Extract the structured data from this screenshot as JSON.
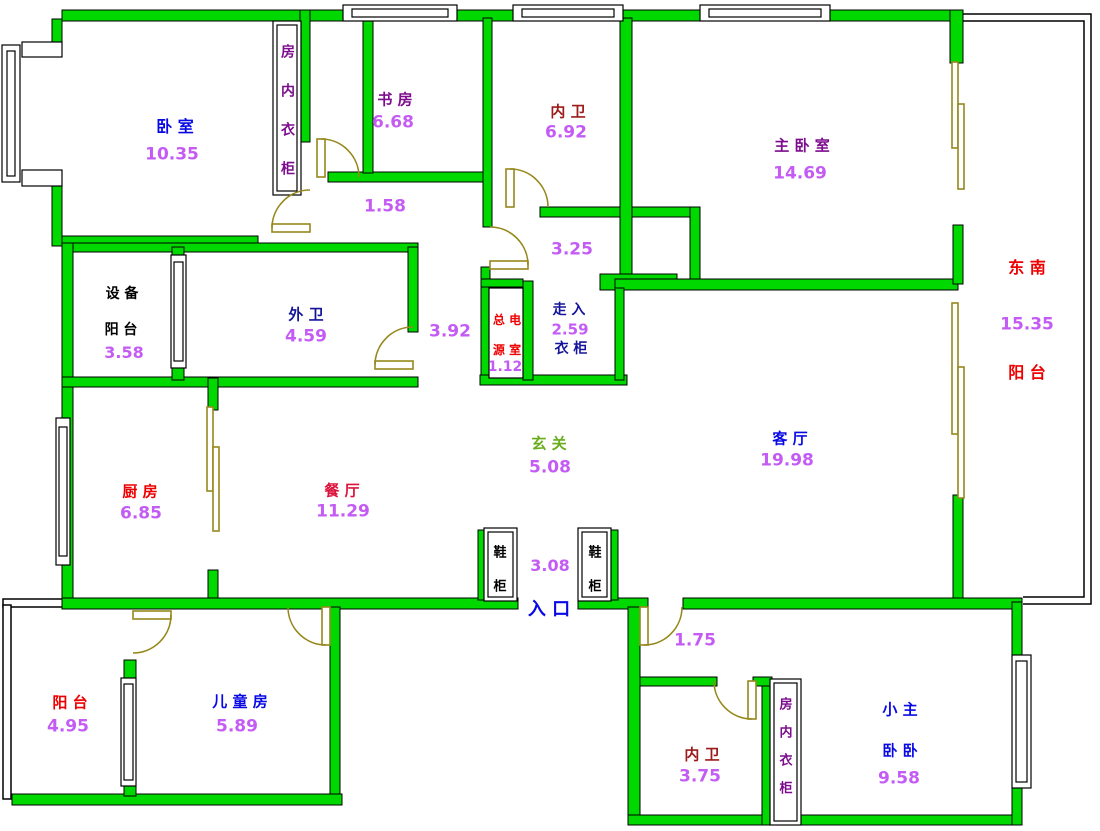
{
  "plan": {
    "title": "apartment-floor-plan",
    "palette": {
      "wall_green": "#00D900",
      "wall_outline": "#000000",
      "door_olive": "#96881C",
      "room_blue": "#0909E6",
      "room_purple": "#7D0C8E",
      "room_darkred": "#9B1A1A",
      "room_red": "#EE0000",
      "room_crimson": "#DC143C",
      "room_navy": "#14149B",
      "hall_green": "#69AD1C",
      "area_number": "#C45BF5",
      "plain_black": "#000000"
    },
    "labels": [
      {
        "name": "bedroom-label",
        "text": "卧 室",
        "x": 175,
        "y": 127,
        "color": "room_blue",
        "size": 16
      },
      {
        "name": "bedroom-area",
        "text": "10.35",
        "x": 172,
        "y": 155,
        "color": "area_number",
        "size": 17
      },
      {
        "name": "bedroom-closet-label",
        "text": "房内衣柜",
        "x": 288,
        "y": 111,
        "color": "room_purple",
        "size": 14,
        "vertical": true,
        "gap": 25
      },
      {
        "name": "study-label",
        "text": "书 房",
        "x": 395,
        "y": 100,
        "color": "room_purple",
        "size": 15
      },
      {
        "name": "study-area",
        "text": "6.68",
        "x": 393,
        "y": 123,
        "color": "area_number",
        "size": 17
      },
      {
        "name": "inner-bath-top-label",
        "text": "内 卫",
        "x": 568,
        "y": 112,
        "color": "room_darkred",
        "size": 15
      },
      {
        "name": "inner-bath-top-area",
        "text": "6.92",
        "x": 566,
        "y": 133,
        "color": "area_number",
        "size": 17
      },
      {
        "name": "master-bedroom-label",
        "text": "主 卧 室",
        "x": 802,
        "y": 146,
        "color": "room_purple",
        "size": 15
      },
      {
        "name": "master-bedroom-area",
        "text": "14.69",
        "x": 800,
        "y": 174,
        "color": "area_number",
        "size": 17
      },
      {
        "name": "corridor-1-area",
        "text": "1.58",
        "x": 385,
        "y": 207,
        "color": "area_number",
        "size": 17
      },
      {
        "name": "corridor-2-area",
        "text": "3.25",
        "x": 572,
        "y": 250,
        "color": "area_number",
        "size": 17
      },
      {
        "name": "southeast-label",
        "text": "东 南",
        "x": 1027,
        "y": 268,
        "color": "room_red",
        "size": 16
      },
      {
        "name": "se-balcony-area",
        "text": "15.35",
        "x": 1027,
        "y": 325,
        "color": "area_number",
        "size": 17
      },
      {
        "name": "se-balcony-label",
        "text": "阳 台",
        "x": 1027,
        "y": 373,
        "color": "room_red",
        "size": 16
      },
      {
        "name": "equip-balcony-label-1",
        "text": "设 备",
        "x": 122,
        "y": 294,
        "color": "plain_black",
        "size": 14
      },
      {
        "name": "equip-balcony-label-2",
        "text": "阳 台",
        "x": 121,
        "y": 330,
        "color": "plain_black",
        "size": 14
      },
      {
        "name": "equip-balcony-area",
        "text": "3.58",
        "x": 124,
        "y": 353,
        "color": "area_number",
        "size": 16
      },
      {
        "name": "outer-bath-label",
        "text": "外 卫",
        "x": 306,
        "y": 315,
        "color": "room_navy",
        "size": 15
      },
      {
        "name": "outer-bath-area",
        "text": "4.59",
        "x": 306,
        "y": 337,
        "color": "area_number",
        "size": 17
      },
      {
        "name": "corridor-3-area",
        "text": "3.92",
        "x": 450,
        "y": 332,
        "color": "area_number",
        "size": 17
      },
      {
        "name": "power-room-label-1",
        "text": "总 电",
        "x": 507,
        "y": 320,
        "color": "room_red",
        "size": 12
      },
      {
        "name": "power-room-label-2",
        "text": "源 室",
        "x": 507,
        "y": 350,
        "color": "room_red",
        "size": 12
      },
      {
        "name": "power-room-area",
        "text": "1.12",
        "x": 505,
        "y": 367,
        "color": "area_number",
        "size": 14
      },
      {
        "name": "walkin-closet-label-1",
        "text": "走 入",
        "x": 569,
        "y": 310,
        "color": "room_navy",
        "size": 14
      },
      {
        "name": "walkin-closet-area",
        "text": "2.59",
        "x": 570,
        "y": 330,
        "color": "area_number",
        "size": 15
      },
      {
        "name": "walkin-closet-label-2",
        "text": "衣 柜",
        "x": 571,
        "y": 349,
        "color": "room_navy",
        "size": 14
      },
      {
        "name": "entry-hall-label",
        "text": "玄 关",
        "x": 549,
        "y": 444,
        "color": "hall_green",
        "size": 15
      },
      {
        "name": "entry-hall-area",
        "text": "5.08",
        "x": 550,
        "y": 468,
        "color": "area_number",
        "size": 17
      },
      {
        "name": "living-room-label",
        "text": "客 厅",
        "x": 790,
        "y": 439,
        "color": "room_blue",
        "size": 15
      },
      {
        "name": "living-room-area",
        "text": "19.98",
        "x": 787,
        "y": 461,
        "color": "area_number",
        "size": 17
      },
      {
        "name": "kitchen-label",
        "text": "厨 房",
        "x": 140,
        "y": 492,
        "color": "room_red",
        "size": 15
      },
      {
        "name": "kitchen-area",
        "text": "6.85",
        "x": 141,
        "y": 514,
        "color": "area_number",
        "size": 17
      },
      {
        "name": "dining-label",
        "text": "餐 厅",
        "x": 342,
        "y": 491,
        "color": "room_crimson",
        "size": 15
      },
      {
        "name": "dining-area",
        "text": "11.29",
        "x": 343,
        "y": 512,
        "color": "area_number",
        "size": 17
      },
      {
        "name": "shoe-cabinet-left-label",
        "text": "鞋柜",
        "x": 500,
        "y": 570,
        "color": "plain_black",
        "size": 13,
        "vertical": true,
        "gap": 21
      },
      {
        "name": "entry-width-area",
        "text": "3.08",
        "x": 550,
        "y": 566,
        "color": "area_number",
        "size": 16
      },
      {
        "name": "shoe-cabinet-right-label",
        "text": "鞋柜",
        "x": 595,
        "y": 570,
        "color": "plain_black",
        "size": 13,
        "vertical": true,
        "gap": 21
      },
      {
        "name": "entrance-label",
        "text": "入 口",
        "x": 549,
        "y": 610,
        "color": "room_blue",
        "size": 18
      },
      {
        "name": "bl-balcony-label",
        "text": "阳 台",
        "x": 70,
        "y": 703,
        "color": "room_red",
        "size": 15
      },
      {
        "name": "bl-balcony-area",
        "text": "4.95",
        "x": 68,
        "y": 727,
        "color": "area_number",
        "size": 17
      },
      {
        "name": "children-room-label",
        "text": "儿 童 房",
        "x": 240,
        "y": 702,
        "color": "room_blue",
        "size": 15
      },
      {
        "name": "children-room-area",
        "text": "5.89",
        "x": 237,
        "y": 727,
        "color": "area_number",
        "size": 17
      },
      {
        "name": "suite-corridor-area",
        "text": "1.75",
        "x": 695,
        "y": 641,
        "color": "area_number",
        "size": 17
      },
      {
        "name": "inner-bath-bottom-label",
        "text": "内 卫",
        "x": 702,
        "y": 755,
        "color": "room_darkred",
        "size": 15
      },
      {
        "name": "inner-bath-bottom-area",
        "text": "3.75",
        "x": 700,
        "y": 777,
        "color": "area_number",
        "size": 17
      },
      {
        "name": "suite-closet-label",
        "text": "房内衣柜",
        "x": 786,
        "y": 747,
        "color": "room_purple",
        "size": 13,
        "vertical": true,
        "gap": 15
      },
      {
        "name": "small-master-label-1",
        "text": "小 主",
        "x": 900,
        "y": 710,
        "color": "room_blue",
        "size": 15
      },
      {
        "name": "small-master-label-2",
        "text": "卧 卧",
        "x": 900,
        "y": 751,
        "color": "room_blue",
        "size": 15
      },
      {
        "name": "small-master-area",
        "text": "9.58",
        "x": 899,
        "y": 779,
        "color": "area_number",
        "size": 17
      }
    ]
  }
}
